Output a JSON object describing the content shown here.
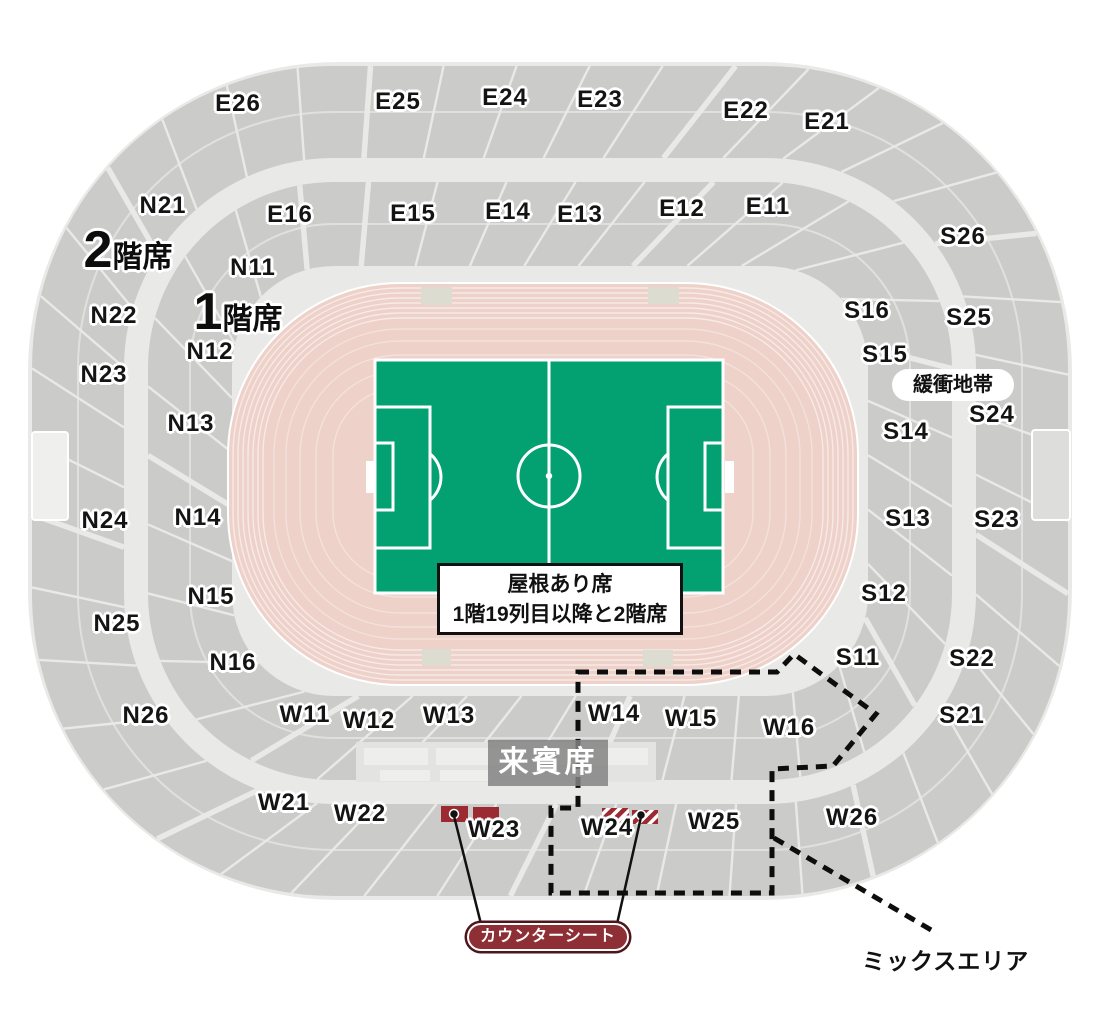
{
  "legend": {
    "floor2_big": "2",
    "floor2_small": "階席",
    "floor1_big": "1",
    "floor1_small": "階席"
  },
  "sections": [
    {
      "label": "E26",
      "x": 238,
      "y": 104
    },
    {
      "label": "E25",
      "x": 398,
      "y": 102
    },
    {
      "label": "E24",
      "x": 505,
      "y": 98
    },
    {
      "label": "E23",
      "x": 600,
      "y": 100
    },
    {
      "label": "E22",
      "x": 746,
      "y": 111
    },
    {
      "label": "E21",
      "x": 827,
      "y": 122
    },
    {
      "label": "E16",
      "x": 290,
      "y": 215
    },
    {
      "label": "E15",
      "x": 413,
      "y": 214
    },
    {
      "label": "E14",
      "x": 508,
      "y": 212
    },
    {
      "label": "E13",
      "x": 580,
      "y": 215
    },
    {
      "label": "E12",
      "x": 682,
      "y": 209
    },
    {
      "label": "E11",
      "x": 768,
      "y": 207
    },
    {
      "label": "N21",
      "x": 163,
      "y": 206
    },
    {
      "label": "N22",
      "x": 114,
      "y": 316
    },
    {
      "label": "N23",
      "x": 104,
      "y": 375
    },
    {
      "label": "N24",
      "x": 105,
      "y": 521
    },
    {
      "label": "N25",
      "x": 117,
      "y": 624
    },
    {
      "label": "N26",
      "x": 146,
      "y": 716
    },
    {
      "label": "N11",
      "x": 253,
      "y": 268
    },
    {
      "label": "N12",
      "x": 210,
      "y": 352
    },
    {
      "label": "N13",
      "x": 191,
      "y": 424
    },
    {
      "label": "N14",
      "x": 198,
      "y": 518
    },
    {
      "label": "N15",
      "x": 211,
      "y": 597
    },
    {
      "label": "N16",
      "x": 233,
      "y": 663
    },
    {
      "label": "S26",
      "x": 963,
      "y": 237
    },
    {
      "label": "S25",
      "x": 969,
      "y": 318
    },
    {
      "label": "S24",
      "x": 992,
      "y": 415
    },
    {
      "label": "S23",
      "x": 997,
      "y": 520
    },
    {
      "label": "S22",
      "x": 972,
      "y": 659
    },
    {
      "label": "S21",
      "x": 962,
      "y": 716
    },
    {
      "label": "S16",
      "x": 867,
      "y": 311
    },
    {
      "label": "S15",
      "x": 885,
      "y": 355
    },
    {
      "label": "S14",
      "x": 906,
      "y": 432
    },
    {
      "label": "S13",
      "x": 908,
      "y": 519
    },
    {
      "label": "S12",
      "x": 884,
      "y": 594
    },
    {
      "label": "S11",
      "x": 858,
      "y": 658
    },
    {
      "label": "W11",
      "x": 305,
      "y": 715
    },
    {
      "label": "W12",
      "x": 369,
      "y": 721
    },
    {
      "label": "W13",
      "x": 449,
      "y": 716
    },
    {
      "label": "W14",
      "x": 614,
      "y": 714
    },
    {
      "label": "W15",
      "x": 691,
      "y": 719
    },
    {
      "label": "W16",
      "x": 789,
      "y": 728
    },
    {
      "label": "W21",
      "x": 284,
      "y": 803
    },
    {
      "label": "W22",
      "x": 360,
      "y": 814
    },
    {
      "label": "W23",
      "x": 494,
      "y": 830
    },
    {
      "label": "W24",
      "x": 607,
      "y": 828
    },
    {
      "label": "W25",
      "x": 714,
      "y": 822
    },
    {
      "label": "W26",
      "x": 852,
      "y": 818
    }
  ],
  "annotations": {
    "buffer_zone": "緩衝地帯",
    "roof_note_line1": "屋根あり席",
    "roof_note_line2": "1階19列目以降と2階席",
    "vip": "来賓席",
    "counter_seat": "カウンターシート",
    "mix_area": "ミックスエリア"
  },
  "colors": {
    "field_green": "#03a172",
    "track_pink": "#eed1c9",
    "stand_gray": "#cbcbca",
    "walkway_gray": "#e9eae7",
    "marker_red": "#9c2a33",
    "counter_pill_red": "#8e2f36",
    "vip_gray": "#848484"
  }
}
